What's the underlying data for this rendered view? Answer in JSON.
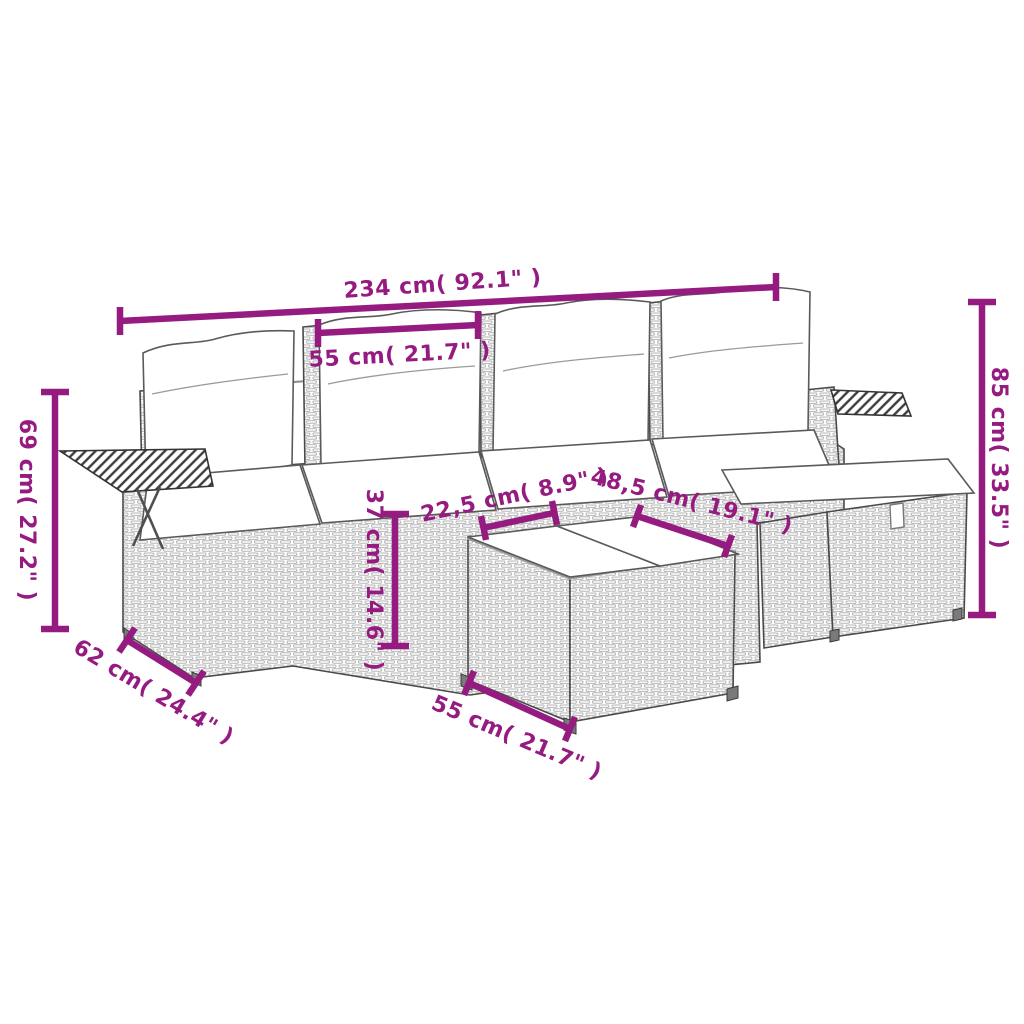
{
  "diagram": {
    "colors": {
      "accent": "#951B81",
      "outline": "#4A4A4A",
      "weave": "#B5B5B5",
      "background": "#FFFFFF"
    },
    "dimensions": [
      {
        "name": "overall-width",
        "label": "234 cm( 92.1\" )"
      },
      {
        "name": "back-cushion-width",
        "label": "55 cm( 21.7\" )"
      },
      {
        "name": "armrest-side-height",
        "label": "69 cm( 27.2\" )"
      },
      {
        "name": "overall-height",
        "label": "85 cm( 33.5\" )"
      },
      {
        "name": "seat-depth",
        "label": "62 cm( 24.4\" )"
      },
      {
        "name": "seat-height",
        "label": "37 cm( 14.6\" )"
      },
      {
        "name": "table-top-depth",
        "label": "22,5 cm( 8.9\" )"
      },
      {
        "name": "table-diagonal",
        "label": "48,5 cm( 19.1\" )"
      },
      {
        "name": "table-width",
        "label": "55 cm( 21.7\" )"
      }
    ]
  }
}
